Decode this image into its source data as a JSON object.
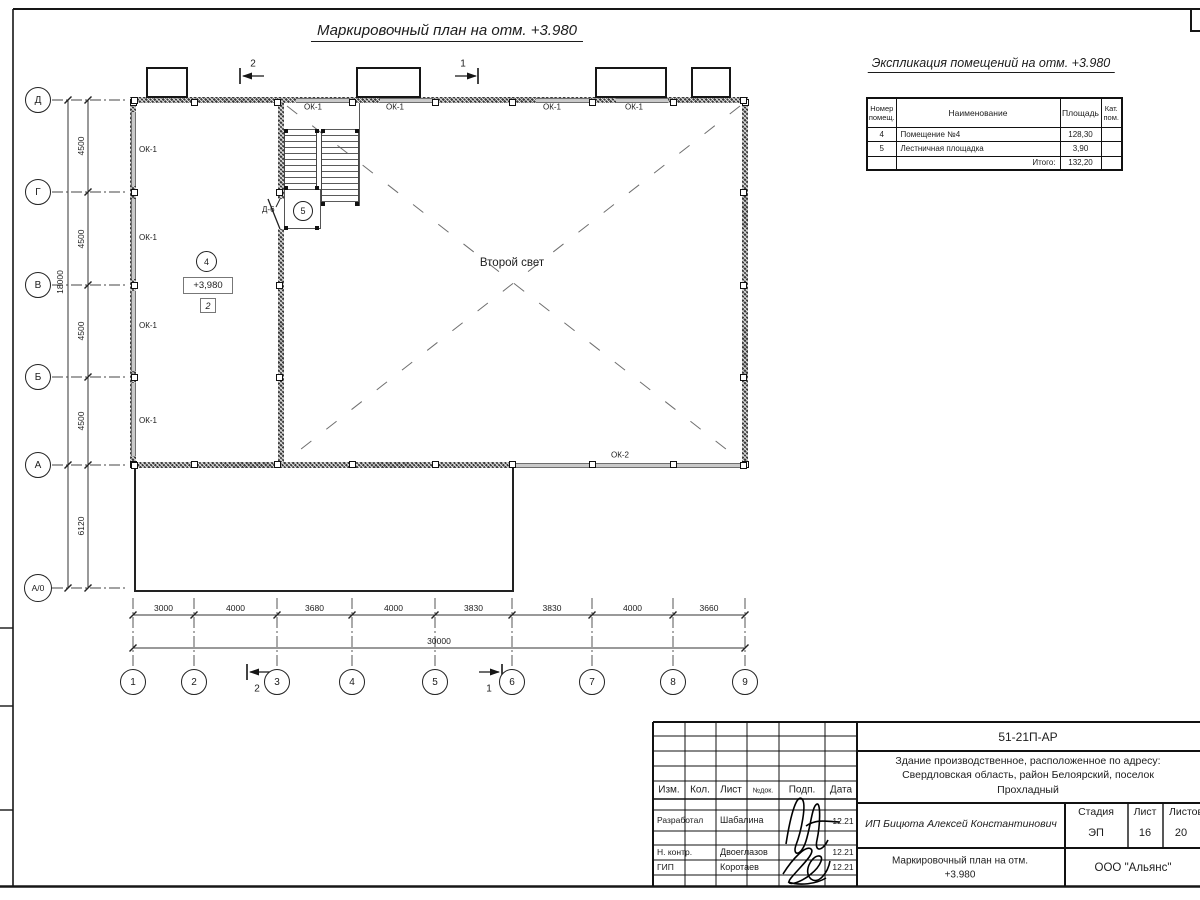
{
  "sheet": {
    "plan_title": "Маркировочный план на отм. +3.980",
    "explication": {
      "title": "Экспликация помещений на отм. +3.980",
      "headers": {
        "num1": "Номер",
        "num2": "помещ.",
        "name": "Наименование",
        "area": "Площадь",
        "cat1": "Кат.",
        "cat2": "пом."
      },
      "rows": [
        {
          "num": "4",
          "name": "Помещение №4",
          "area": "128,30",
          "cat": ""
        },
        {
          "num": "5",
          "name": "Лестничная площадка",
          "area": "3,90",
          "cat": ""
        }
      ],
      "total_label": "Итого:",
      "total_value": "132,20"
    },
    "plan": {
      "second_light": "Второй свет",
      "room4_number": "4",
      "room4_elevation": "+3,980",
      "room4_category": "2",
      "stair_number": "5",
      "door_mark": "Д-6",
      "window_marks": [
        "ОК-1",
        "ОК-1",
        "ОК-1",
        "ОК-1",
        "ОК-1",
        "ОК-1",
        "ОК-1",
        "ОК-1",
        "ОК-2"
      ],
      "section_markers": {
        "top_left": "2",
        "top_right": "1",
        "bottom_left": "2",
        "bottom_right": "1"
      }
    },
    "axes": {
      "rows": [
        "Д",
        "Г",
        "В",
        "Б",
        "А",
        "А/0"
      ],
      "cols": [
        "1",
        "2",
        "3",
        "4",
        "5",
        "6",
        "7",
        "8",
        "9"
      ]
    },
    "dims": {
      "col_segments": [
        "3000",
        "4000",
        "3680",
        "4000",
        "3830",
        "3830",
        "4000",
        "3660"
      ],
      "col_total": "30000",
      "row_segments": [
        "4500",
        "4500",
        "4500",
        "4500"
      ],
      "row_total": "18000",
      "annex_depth": "6120"
    },
    "title_block": {
      "doc_number": "51-21П-АР",
      "address_line1": "Здание производственное, расположенное по адресу:",
      "address_line2": "Свердловская область, район Белоярский, поселок",
      "address_line3": "Прохладный",
      "col_headers": {
        "izm": "Изм.",
        "kol": "Кол.",
        "list": "Лист",
        "ndok": "№док.",
        "podp": "Подп.",
        "data": "Дата"
      },
      "people": [
        {
          "role": "Разработал",
          "name": "Шабалина",
          "date": "12.21"
        },
        {
          "role": "Н. контр.",
          "name": "Двоеглазов",
          "date": "12.21"
        },
        {
          "role": "ГИП",
          "name": "Коротаев",
          "date": "12.21"
        }
      ],
      "client": "ИП Бицюта Алексей Константинович",
      "stage_headers": {
        "stage": "Стадия",
        "sheet": "Лист",
        "sheets": "Листов"
      },
      "stage_values": {
        "stage": "ЭП",
        "sheet": "16",
        "sheets": "20"
      },
      "drawing_name_line1": "Маркировочный план на отм.",
      "drawing_name_line2": "+3.980",
      "company": "ООО \"Альянс\""
    }
  }
}
